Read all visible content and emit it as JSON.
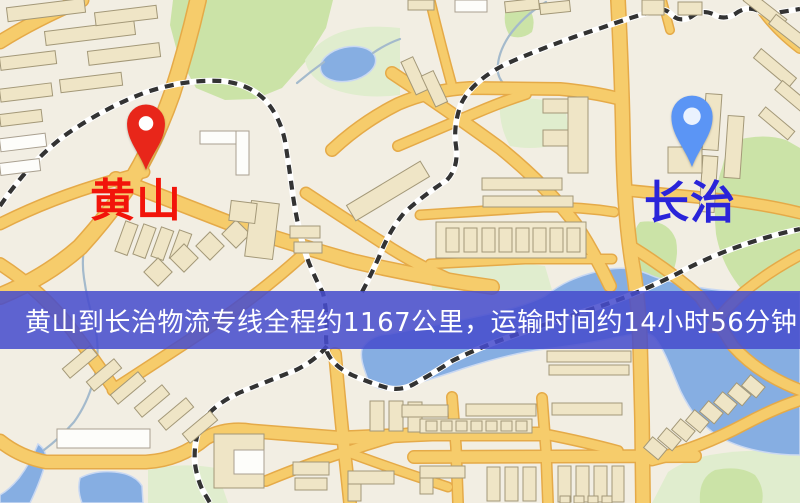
{
  "map": {
    "banner": {
      "text": "黄山到长治物流专线全程约1167公里，运输时间约14小时56分钟.",
      "bg_color": "rgba(70,76,205,0.86)",
      "bg_color_hex": "#464CCD",
      "text_color": "#FFFFFF"
    },
    "markers": [
      {
        "label": "黄山",
        "pin_color": "#E8261A",
        "pin_hole_color": "#FFFFFF",
        "label_color": "#F2140A"
      },
      {
        "label": "长治",
        "pin_color": "#5B95F5",
        "pin_hole_color": "#EAF2FE",
        "label_color": "#2A24D9"
      }
    ],
    "palette": {
      "land": "#F2EEE3",
      "road_fill": "#F6CC6B",
      "road_casing": "#E5AA48",
      "park": "#CBE3A7",
      "park_pale": "#E0EDCE",
      "water": "#86AEE2",
      "building_fill": "#EFE5C6",
      "building_stroke": "#A39878",
      "rail": "#333333",
      "stream": "#A4BACC"
    }
  }
}
